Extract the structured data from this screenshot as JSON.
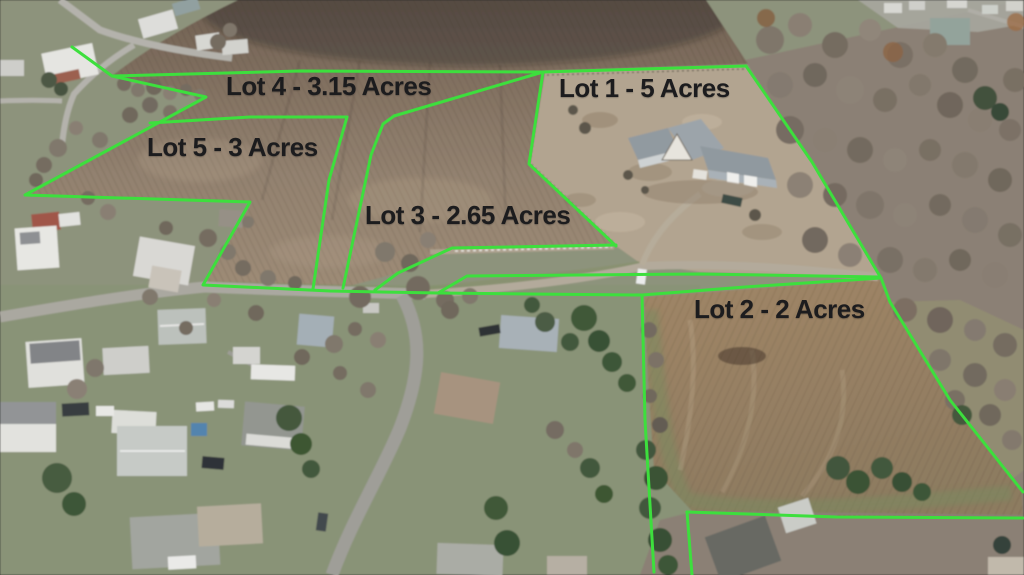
{
  "lots": [
    {
      "name": "lot-1",
      "label": "Lot 1 - 5 Acres",
      "acres": "5"
    },
    {
      "name": "lot-2",
      "label": "Lot 2 - 2 Acres",
      "acres": "2"
    },
    {
      "name": "lot-3",
      "label": "Lot 3 - 2.65 Acres",
      "acres": "2.65"
    },
    {
      "name": "lot-4",
      "label": "Lot 4 - 3.15 Acres",
      "acres": "3.15"
    },
    {
      "name": "lot-5",
      "label": "Lot 5 - 3 Acres",
      "acres": "3"
    }
  ],
  "style": {
    "boundary_color": "#3ddf3d",
    "label_color": "#1c1c1e"
  }
}
